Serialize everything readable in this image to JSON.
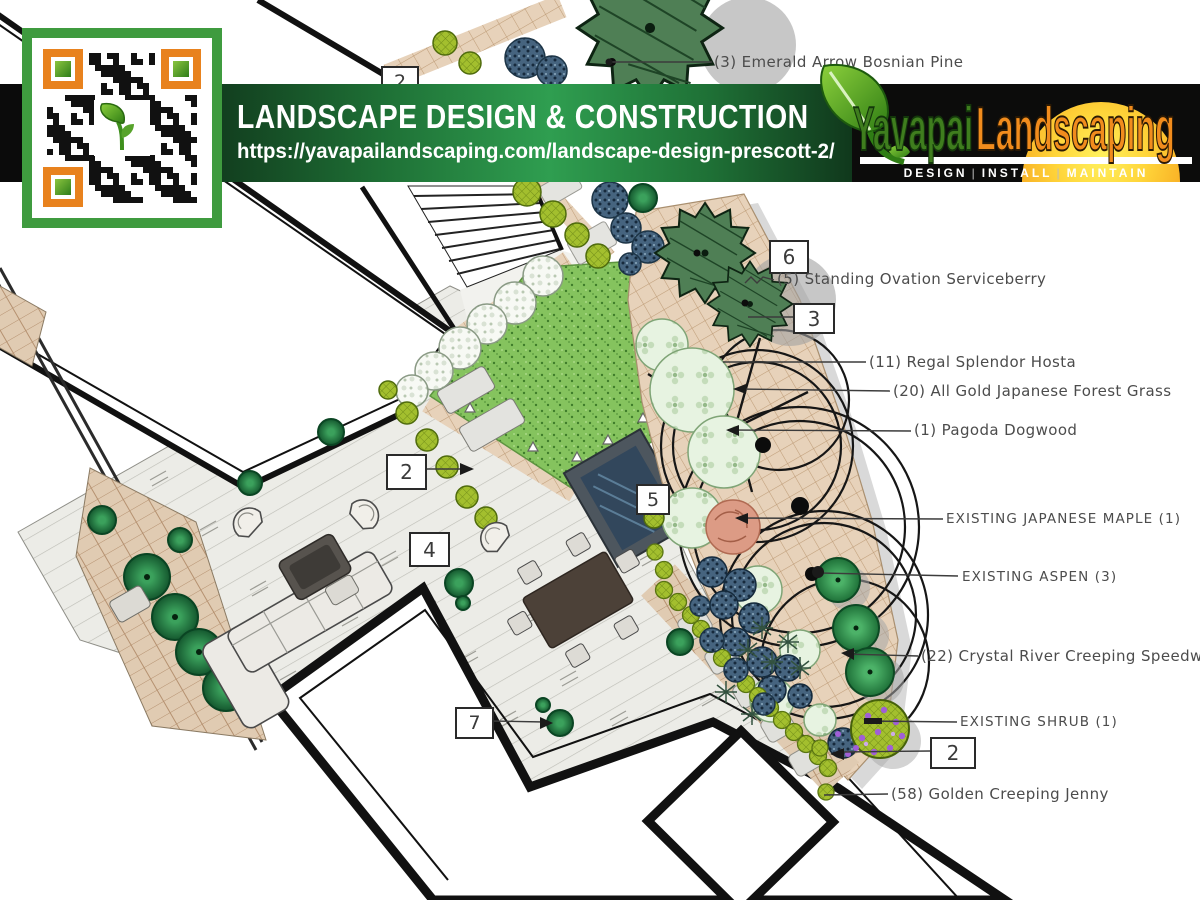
{
  "banner": {
    "title": "LANDSCAPE DESIGN & CONSTRUCTION",
    "url": "https://yavapailandscaping.com/landscape-design-prescott-2/",
    "green": "#2f9e50",
    "black": "#0b0b0b"
  },
  "logo": {
    "name_part1": "Yavapai",
    "name_part2": "Landscaping",
    "tagline": [
      "DESIGN",
      "INSTALL",
      "MAINTAIN"
    ],
    "colors": {
      "green": "#3f7d1e",
      "orange": "#f18c1d",
      "sun_top": "#fff15e",
      "sun_bottom": "#ef8c12"
    }
  },
  "qr": {
    "border_color": "#3f9b3f",
    "finder_color": "#e8821e"
  },
  "plan": {
    "callouts": [
      {
        "n": "2"
      },
      {
        "n": "6"
      },
      {
        "n": "3"
      },
      {
        "n": "2"
      },
      {
        "n": "5"
      },
      {
        "n": "4"
      },
      {
        "n": "7"
      },
      {
        "n": "2"
      }
    ],
    "labels": [
      {
        "text": "(3) Emerald Arrow Bosnian Pine"
      },
      {
        "text": "(5) Standing Ovation Serviceberry"
      },
      {
        "text": "(11) Regal Splendor Hosta"
      },
      {
        "text": "(20) All Gold Japanese Forest Grass"
      },
      {
        "text": "(1) Pagoda Dogwood"
      },
      {
        "text": "EXISTING JAPANESE MAPLE (1)"
      },
      {
        "text": "EXISTING ASPEN (3)"
      },
      {
        "text": "(22) Crystal River Creeping Speedwell"
      },
      {
        "text": "EXISTING SHRUB (1)"
      },
      {
        "text": "(58) Golden Creeping Jenny"
      }
    ]
  }
}
